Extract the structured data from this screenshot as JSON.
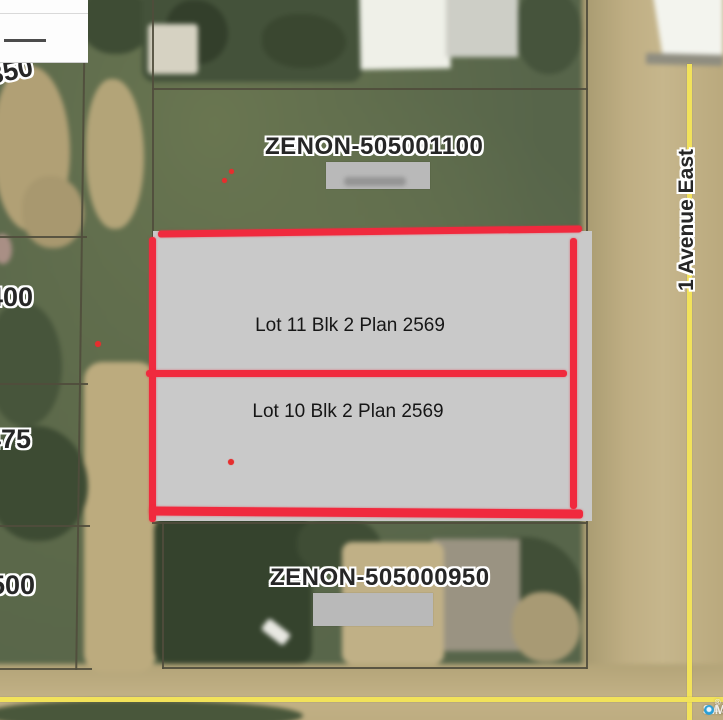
{
  "map": {
    "street_label": "1 Avenue East",
    "parcel_top": {
      "id": "ZENON-505001100"
    },
    "parcel_bottom": {
      "id": "ZENON-505000950"
    },
    "highlighted_lots": [
      {
        "label": "Lot 11 Blk 2 Plan 2569"
      },
      {
        "label": "Lot 10 Blk 2 Plan 2569"
      }
    ],
    "address_labels": [
      "350",
      "400",
      "475",
      "500"
    ],
    "watermark": {
      "sask": "SASK",
      "mls": "MLS",
      "reg": "®"
    },
    "colors": {
      "highlight_outline": "#f02a3e",
      "highlight_fill": "#c9c9c9",
      "road_centerline": "#f2e25a",
      "grass": "#57654a",
      "road": "#b9a87c"
    }
  }
}
